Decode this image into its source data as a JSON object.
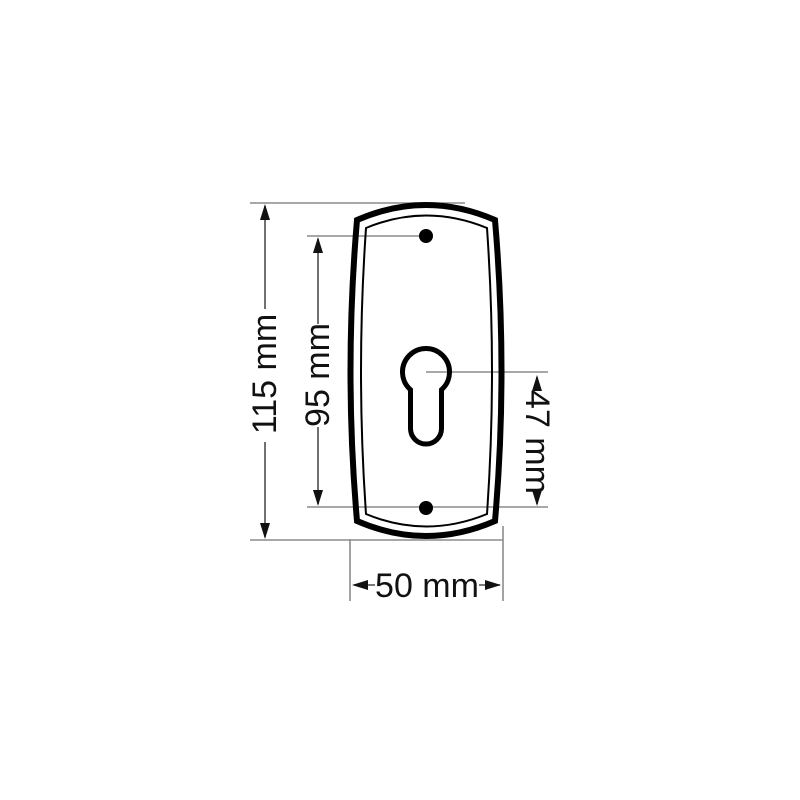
{
  "drawing": {
    "labels": {
      "overall_height": "115 mm",
      "hole_spacing": "95 mm",
      "cylinder_offset": "47 mm",
      "overall_width": "50 mm"
    },
    "colors": {
      "background": "#ffffff",
      "plate_outline": "#000000",
      "extension_line": "#8c8c8c",
      "dimension_line": "#4d4d4d",
      "arrowhead": "#111111",
      "label_text": "#111111"
    }
  }
}
